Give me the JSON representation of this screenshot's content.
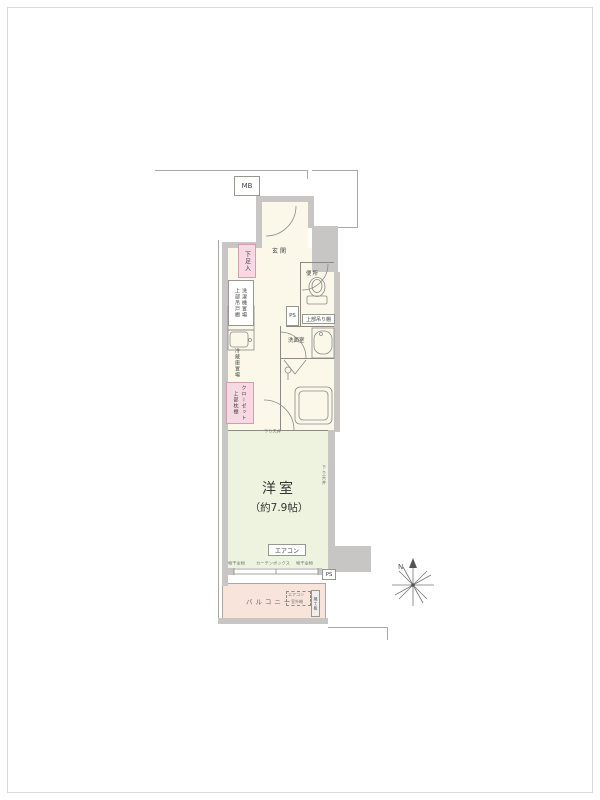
{
  "colors": {
    "wall_fill": "#c7c6c4",
    "outline": "#9b9b99",
    "interior_cream": "#fbf8ea",
    "room_green": "#edf3de",
    "balcony_peach": "#f8e4da",
    "closet_pink": "#f7d9e3",
    "text": "#444444"
  },
  "floorplan": {
    "meter_box": "MB",
    "entrance": "玄関",
    "shoe_box": "下足入",
    "laundry": {
      "label": "洗濯機置場",
      "shelf": "上部吊戸棚"
    },
    "fridge": "冷蔵庫置場",
    "closet": {
      "label": "クローゼット",
      "shelf": "上部枕棚"
    },
    "toilet": {
      "label": "便所",
      "shelf": "上部吊り棚"
    },
    "ps_upper": "PS",
    "washroom": "洗面室",
    "main_room": {
      "name": "洋室",
      "size": "（約7.9帖）"
    },
    "aircon": "エアコン",
    "lowered_ceiling": "下り天井",
    "window": {
      "left": "物干金物",
      "center": "カーテンボックス",
      "right": "物干金物"
    },
    "ps_lower": "PS",
    "balcony": {
      "label": "バルコニー",
      "outdoor_unit_line1": "エアコン",
      "outdoor_unit_line2": "室外機",
      "partition": "隔て板"
    },
    "compass_n": "N"
  }
}
